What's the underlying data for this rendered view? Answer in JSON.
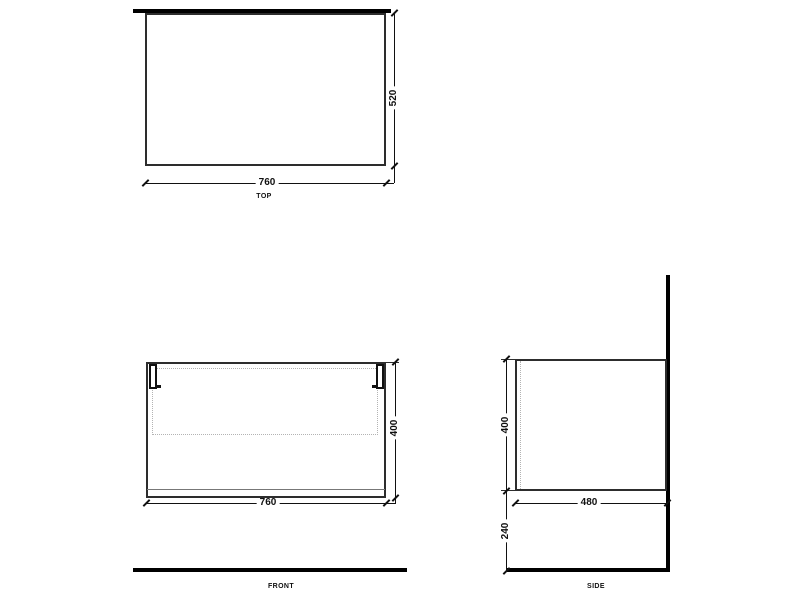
{
  "drawing": {
    "colors": {
      "line": "#2d2d2d",
      "thick_line": "#000000",
      "dashed_line": "#b3b3b3",
      "background": "#ffffff"
    },
    "views": {
      "top": {
        "label": "TOP",
        "dim_width": "760",
        "dim_depth": "520"
      },
      "front": {
        "label": "FRONT",
        "dim_width": "760",
        "dim_height": "400"
      },
      "side": {
        "label": "SIDE",
        "dim_depth": "480",
        "dim_height": "400",
        "dim_floor_gap": "240"
      }
    }
  }
}
